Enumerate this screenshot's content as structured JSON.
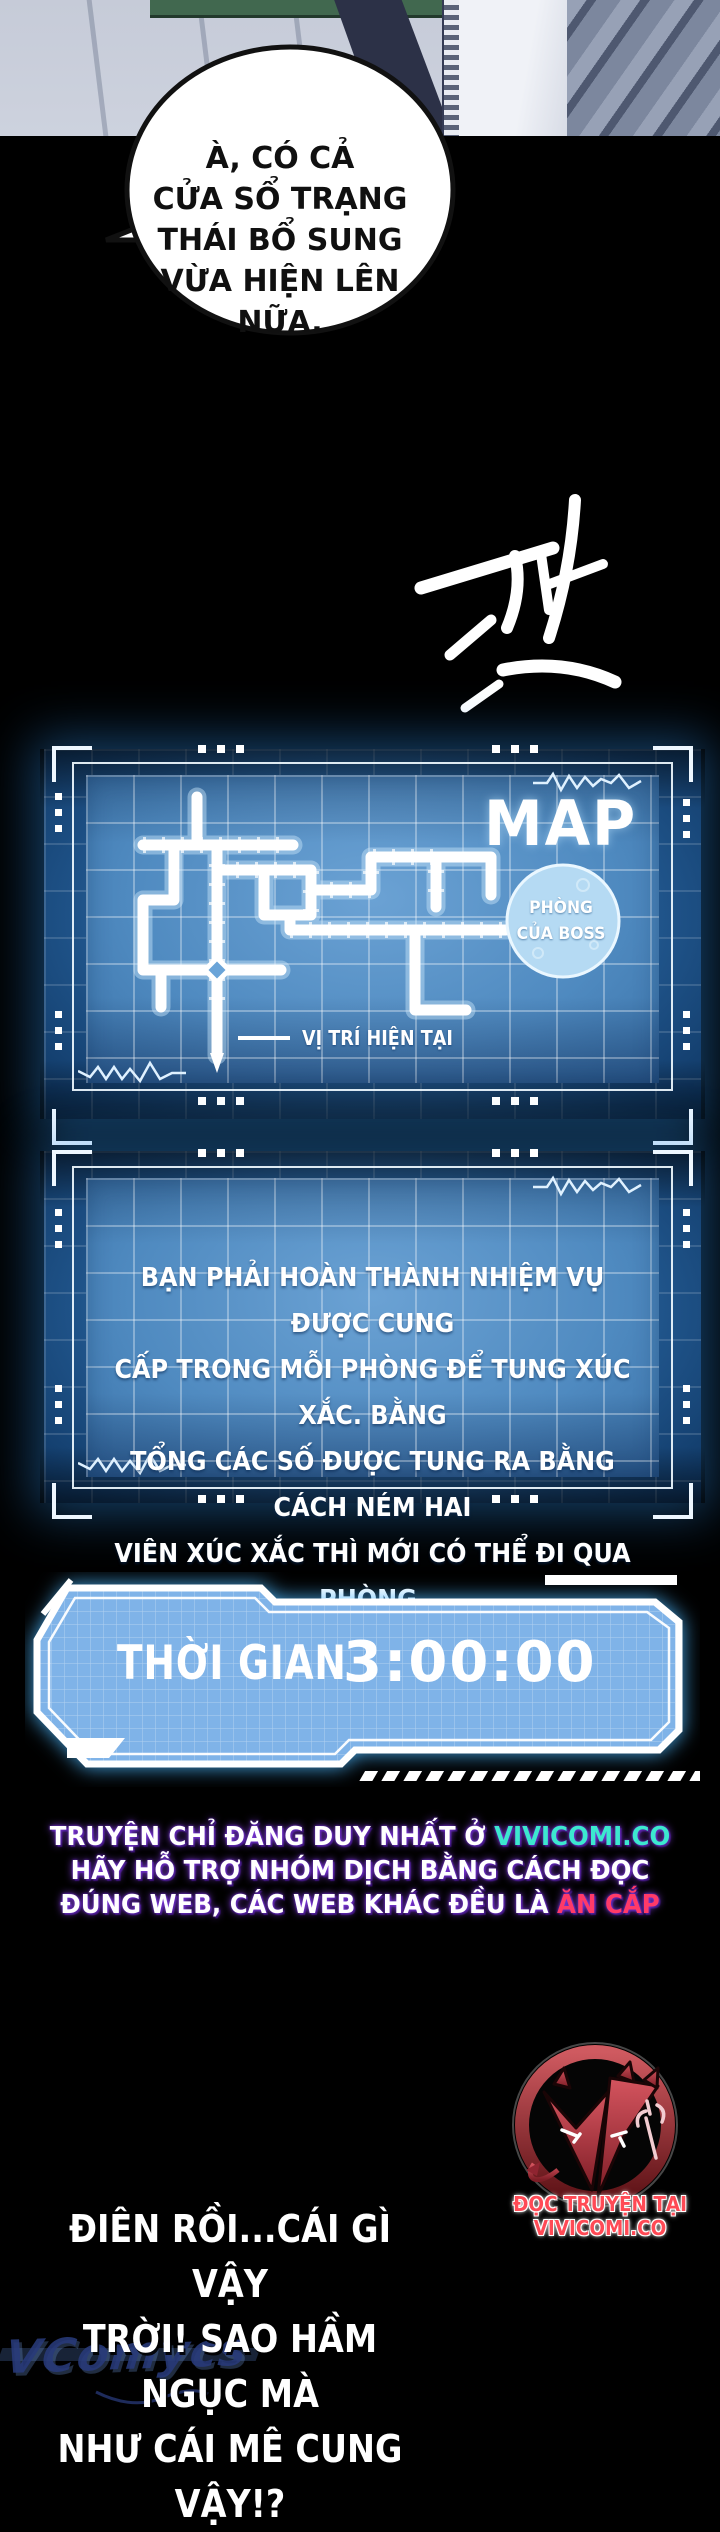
{
  "speech_bubble": {
    "lines": [
      "À, CÓ CẢ",
      "CỬA SỔ TRẠNG",
      "THÁI BỔ SUNG",
      "VỪA HIỆN LÊN",
      "NỮA."
    ]
  },
  "sfx": {
    "glyph": "턱"
  },
  "map_panel": {
    "title": "MAP",
    "boss_room_line1": "PHÒNG",
    "boss_room_line2": "CỦA BOSS",
    "current_position_label": "VỊ TRÍ HIỆN TẠI"
  },
  "rules_panel": {
    "lines": [
      "BẠN PHẢI HOÀN THÀNH NHIỆM VỤ ĐƯỢC CUNG",
      "CẤP TRONG MỖI PHÒNG ĐỂ TUNG XÚC XẮC. BẰNG",
      "TỔNG CÁC SỐ ĐƯỢC TUNG RA BẰNG CÁCH NÉM HAI",
      "VIÊN XÚC XẮC THÌ MỚI CÓ THỂ ĐI QUA PHÒNG."
    ]
  },
  "timer_panel": {
    "label": "THỜI GIAN",
    "value": "3:00:00"
  },
  "credits": {
    "line1_prefix": "TRUYỆN CHỈ ĐĂNG DUY NHẤT Ở ",
    "line1_highlight": "VIVICOMI.CO",
    "line2": "HÃY HỖ TRỢ NHÓM DỊCH BẰNG CÁCH ĐỌC",
    "line3_prefix": "ĐÚNG WEB, CÁC WEB KHÁC ĐỀU LÀ ",
    "line3_highlight": "ĂN CẮP"
  },
  "logo": {
    "caption": "ĐỌC TRUYỆN TẠI VIVICOMI.CO"
  },
  "dialogue_bottom": {
    "lines": [
      "ĐIÊN RỒI...CÁI GÌ VẬY",
      "TRỜI! SAO HẦM NGỤC MÀ",
      "NHƯ CÁI MÊ CUNG VẬY!?"
    ]
  },
  "watermark": {
    "text": "VComycs"
  },
  "colors": {
    "panel_blue": "#3c77b0",
    "panel_inner": "#4f8ac0",
    "panel_glow": "#2f8fe6",
    "boss_circle": "#b5daf3",
    "timer_fill": "#7fb3e8",
    "credit_highlight": "#3ce8cf",
    "credit_warning": "#ff3a68",
    "logo_red": "#c0394a",
    "watermark_blue": "#283a7a"
  }
}
